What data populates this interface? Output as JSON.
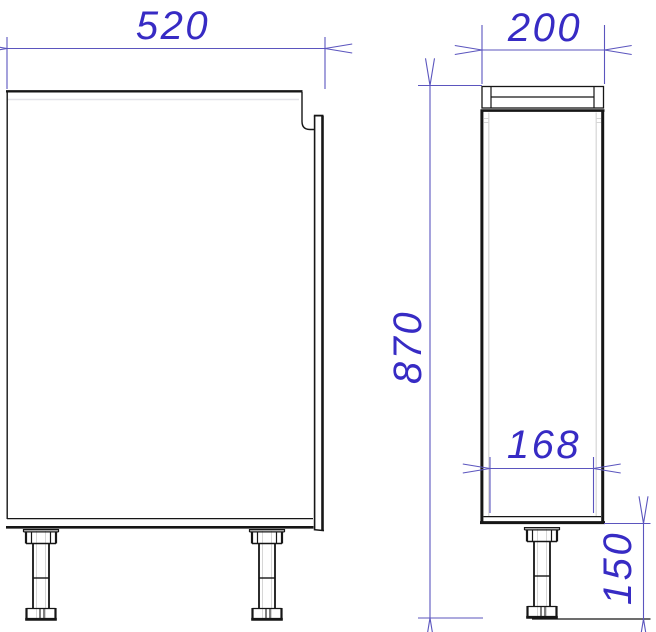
{
  "dimensions": {
    "width": "520",
    "depth": "200",
    "height": "870",
    "inner_width": "168",
    "leg_height": "150"
  },
  "colors": {
    "dimension_text": "#372bc4",
    "dimension_lines": "#5b55be",
    "outline": "#161616",
    "hidden_lines": "#d6d6d6",
    "background": "#ffffff"
  }
}
